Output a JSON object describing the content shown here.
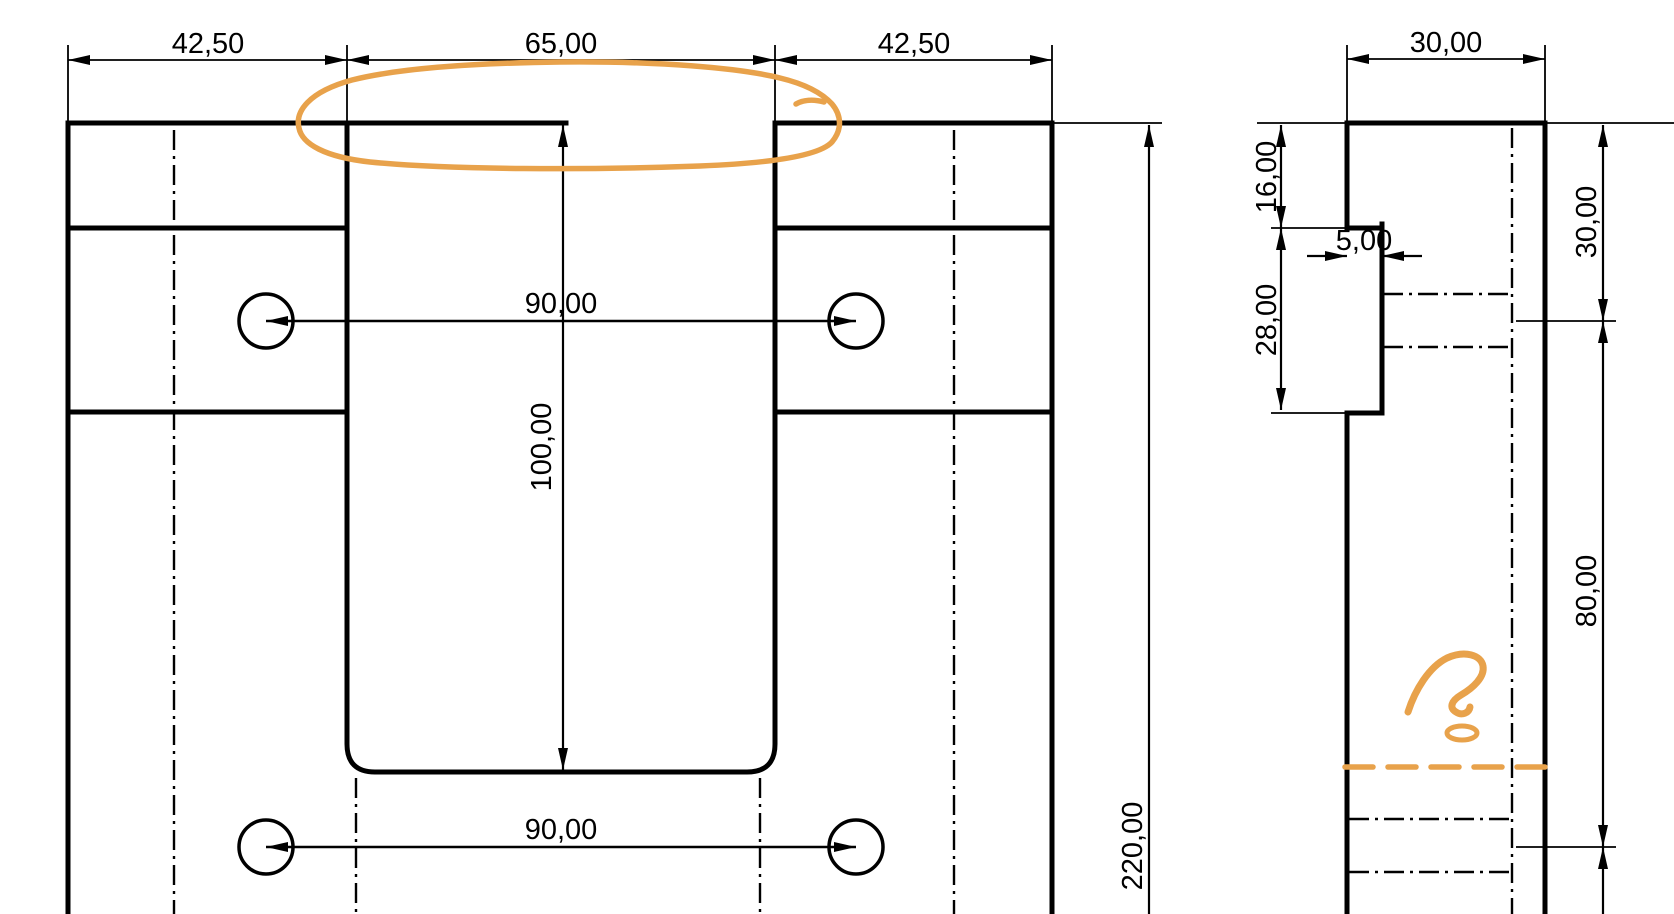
{
  "document": {
    "type": "engineering-drawing",
    "views": [
      "front-view",
      "side-view"
    ],
    "line_color": "#000000",
    "background_color": "#ffffff"
  },
  "front_view": {
    "dim_top_left": "42,50",
    "dim_top_center": "65,00",
    "dim_top_right": "42,50",
    "dim_hole_spacing_upper": "90,00",
    "dim_hole_spacing_lower": "90,00",
    "dim_slot_depth": "100,00",
    "dim_total_height": "220,00"
  },
  "side_view": {
    "dim_width": "30,00",
    "dim_step_offset": "16,00",
    "dim_step_height": "28,00",
    "dim_step_depth": "5,00",
    "dim_hole_offset_top": "30,00",
    "dim_hole_row_spacing": "80,00"
  },
  "annotations": {
    "color": "#E8A24B",
    "items": [
      "highlight-ellipse",
      "question-mark-scribble",
      "missing-line-dashed"
    ]
  }
}
